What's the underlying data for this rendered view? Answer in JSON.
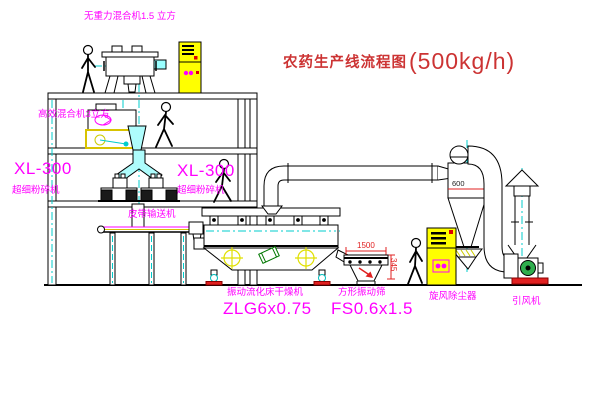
{
  "title": {
    "text": "农药生产线流程图",
    "capacity": "(500kg/h)"
  },
  "equipment_labels": {
    "top_mixer": "无重力混合机1.5 立方",
    "second_mixer": "高效混合机3立方",
    "mill_left_model": "XL-300",
    "mill_left_name": "超细粉碎机",
    "mill_center_model": "XL-300",
    "mill_center_name": "超细粉碎机",
    "belt_conveyor": "皮带输送机",
    "dryer_name": "振动流化床干燥机",
    "dryer_model": "ZLG6x0.75",
    "sieve_name": "方形振动筛",
    "sieve_model": "FS0.6x1.5",
    "cyclone": "旋风除尘器",
    "fan": "引风机"
  },
  "dimensions": {
    "sieve_length": "1500",
    "sieve_height": "345",
    "cyclone_dia": "600"
  },
  "colors": {
    "label_magenta": "#ff00ff",
    "title_red": "#cc3333",
    "dimension_red": "#e02020",
    "centerline_cyan": "#00cccc",
    "cabinet_yellow": "#ffff00",
    "duct_cyan_fill": "#aefcfc"
  }
}
